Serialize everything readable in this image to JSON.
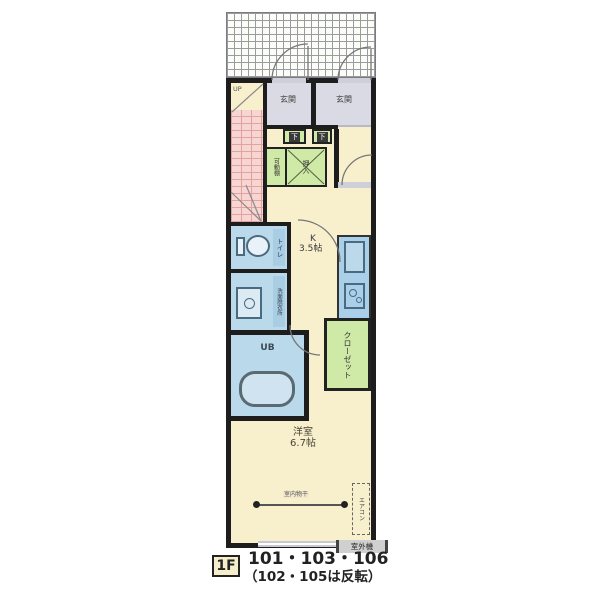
{
  "floorplan": {
    "type": "apartment-floor-plan",
    "labels": {
      "genkan_left": "玄関",
      "genkan_right": "玄関",
      "stairs_direction": "UP",
      "shoe_cabinet_1": "下",
      "shoe_cabinet_2": "下",
      "movable_shelf": "可動棚",
      "oshiire": "押入",
      "toilet": "トイレ",
      "washroom": "洗面脱衣所",
      "kitchen": "K",
      "kitchen_size": "3.5帖",
      "closet": "クローゼット",
      "closet_col_right": "クロー",
      "closet_col_left": "ゼット",
      "unit_bath": "UB",
      "western_room": "洋室",
      "western_room_size": "6.7帖",
      "indoor_laundry_pole": "室内物干",
      "air_conditioner": "エアコン",
      "outdoor_unit": "室外機"
    },
    "caption": {
      "floor": "1F",
      "units": "101・103・106",
      "note": "（102・105は反転）"
    },
    "colors": {
      "wall": "#1d1d1d",
      "room_cream": "#f8f0cd",
      "wet_area_blue": "#badaeb",
      "storage_green": "#cfe9a6",
      "stairs_pink": "#f6d5d2",
      "entrance_gray": "#dadae4",
      "kitchen_counter_blue": "#a9cfe9"
    }
  }
}
